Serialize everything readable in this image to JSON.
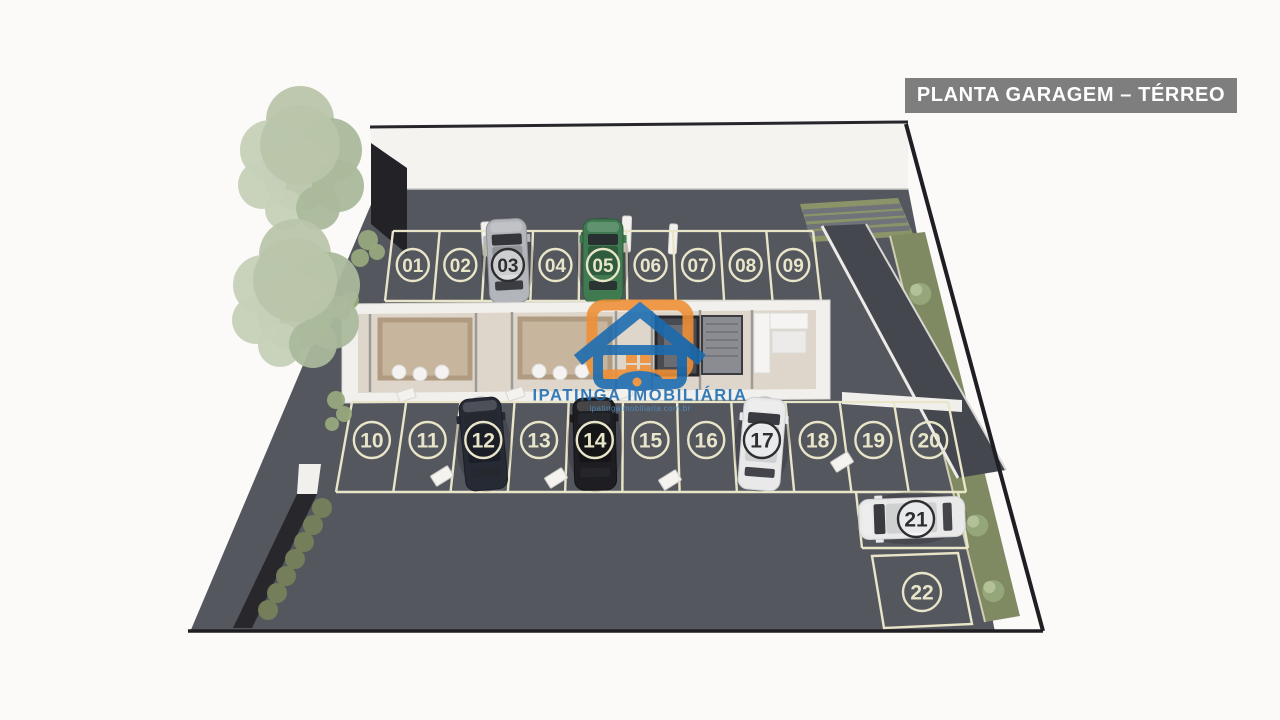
{
  "banner": {
    "label": "PLANTA GARAGEM – TÉRREO"
  },
  "watermark": {
    "name": "IPATINGA IMOBILIÁRIA",
    "url": "ipatingaimobiliaria.com.br"
  },
  "garage": {
    "row_top": {
      "spots": [
        {
          "num": "01"
        },
        {
          "num": "02"
        },
        {
          "num": "03",
          "car": "silver"
        },
        {
          "num": "04"
        },
        {
          "num": "05",
          "car": "green"
        },
        {
          "num": "06"
        },
        {
          "num": "07"
        },
        {
          "num": "08"
        },
        {
          "num": "09"
        }
      ]
    },
    "row_bottom": {
      "spots": [
        {
          "num": "10"
        },
        {
          "num": "11"
        },
        {
          "num": "12",
          "car": "darknavy"
        },
        {
          "num": "13"
        },
        {
          "num": "14",
          "car": "black"
        },
        {
          "num": "15"
        },
        {
          "num": "16"
        },
        {
          "num": "17",
          "car": "white"
        },
        {
          "num": "18"
        },
        {
          "num": "19"
        },
        {
          "num": "20"
        }
      ]
    },
    "spot_21": {
      "num": "21",
      "car": "white"
    },
    "spot_22": {
      "num": "22"
    }
  },
  "colors": {
    "banner_bg": "#7e7e7e",
    "asphalt": "#55575f",
    "ramp": "#45474f",
    "line": "#e9e5c9",
    "badge_dark": "#2e2e30",
    "garden": "#808a62",
    "tree": "#b9c5aa",
    "wall_white": "#f4f3f0",
    "logo_blue": "#1a6bb0",
    "logo_orange": "#ef8f35",
    "boundary_black": "#1f1f23"
  }
}
